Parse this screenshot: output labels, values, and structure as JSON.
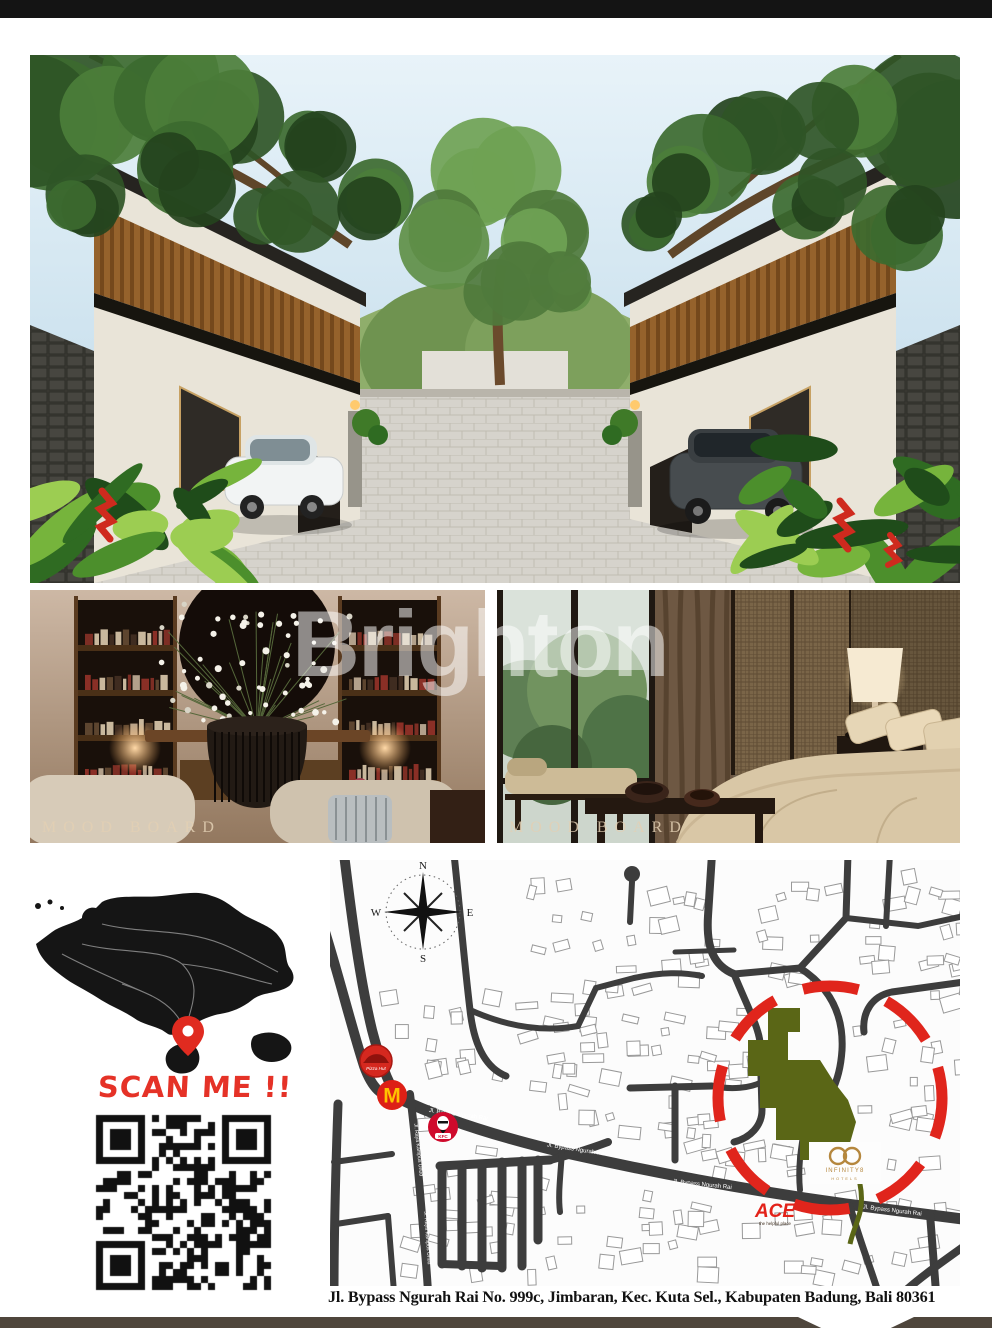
{
  "page": {
    "top_bar_color": "#141414",
    "bottom_bar_color": "#4f463c",
    "accent_red": "#e0251c",
    "site_green": "#5a6616",
    "logo_gold": "#b5873e"
  },
  "watermark": {
    "text": "Brighton"
  },
  "mood_boards": {
    "left_label": "MOOD BOARD",
    "right_label": "MOOD BOARD"
  },
  "location": {
    "scan_me": "SCAN ME !!"
  },
  "map": {
    "compass": {
      "n": "N",
      "e": "E",
      "s": "S",
      "w": "W"
    },
    "road_labels": [
      {
        "text": "Jl. Bypass Ngurah Rai"
      },
      {
        "text": "Jl. Bypass Ngurah Rai"
      },
      {
        "text": "Jl. Bypass Ngurah Rai"
      },
      {
        "text": "Jl. Bypass Ngurah Rai"
      },
      {
        "text": "Jl. Raya Kampus Unud"
      },
      {
        "text": "Jl. Raya Kampus Unud"
      }
    ],
    "brands": {
      "pizza_hut": "Pizza Hut",
      "mcdonalds_m": "M",
      "kfc": "KFC",
      "ace": "ACE",
      "ace_tagline": "the helpful place",
      "infinity": "INFINITY8",
      "infinity_sub": "HOTELS"
    }
  },
  "address": {
    "line": "Jl. Bypass Ngurah Rai No. 999c, Jimbaran, Kec. Kuta Sel., Kabupaten Badung, Bali 80361"
  }
}
